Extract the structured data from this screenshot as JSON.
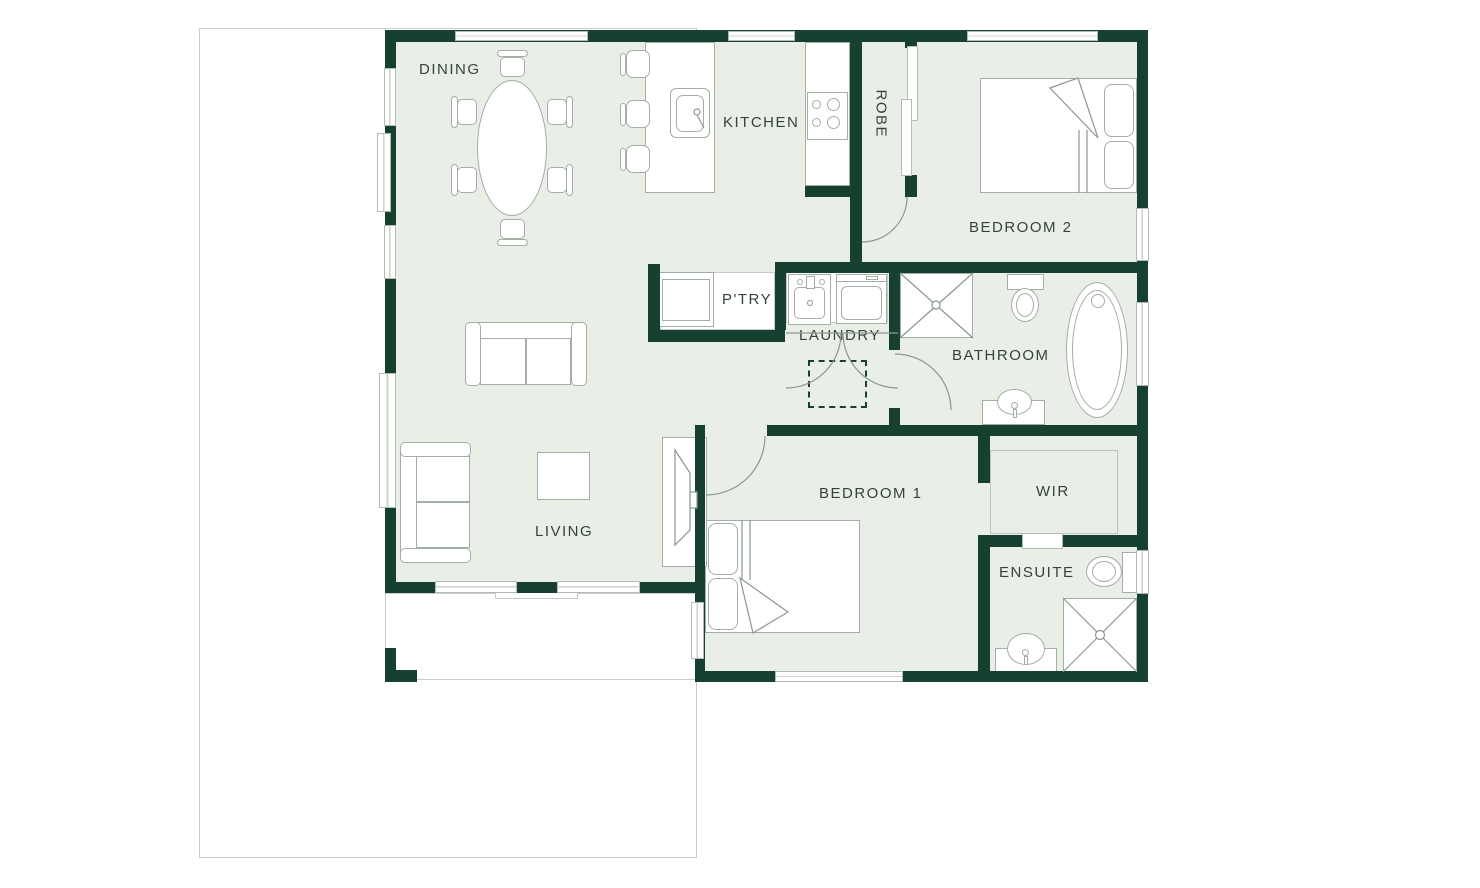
{
  "floorplan": {
    "title": "single-storey house floor plan",
    "rooms": {
      "dining": {
        "label": "DINING"
      },
      "kitchen": {
        "label": "KITCHEN"
      },
      "robe": {
        "label": "ROBE"
      },
      "bedroom2": {
        "label": "BEDROOM 2"
      },
      "pantry": {
        "label": "P'TRY"
      },
      "laundry": {
        "label": "LAUNDRY"
      },
      "bathroom": {
        "label": "BATHROOM"
      },
      "living": {
        "label": "LIVING"
      },
      "bedroom1": {
        "label": "BEDROOM 1"
      },
      "wir": {
        "label": "WIR"
      },
      "ensuite": {
        "label": "ENSUITE"
      }
    },
    "colors": {
      "wall": "#16402f",
      "floor": "#e9efe7",
      "boundary": "#cccccc",
      "line": "#a3aea4",
      "label": "#33423a"
    }
  }
}
